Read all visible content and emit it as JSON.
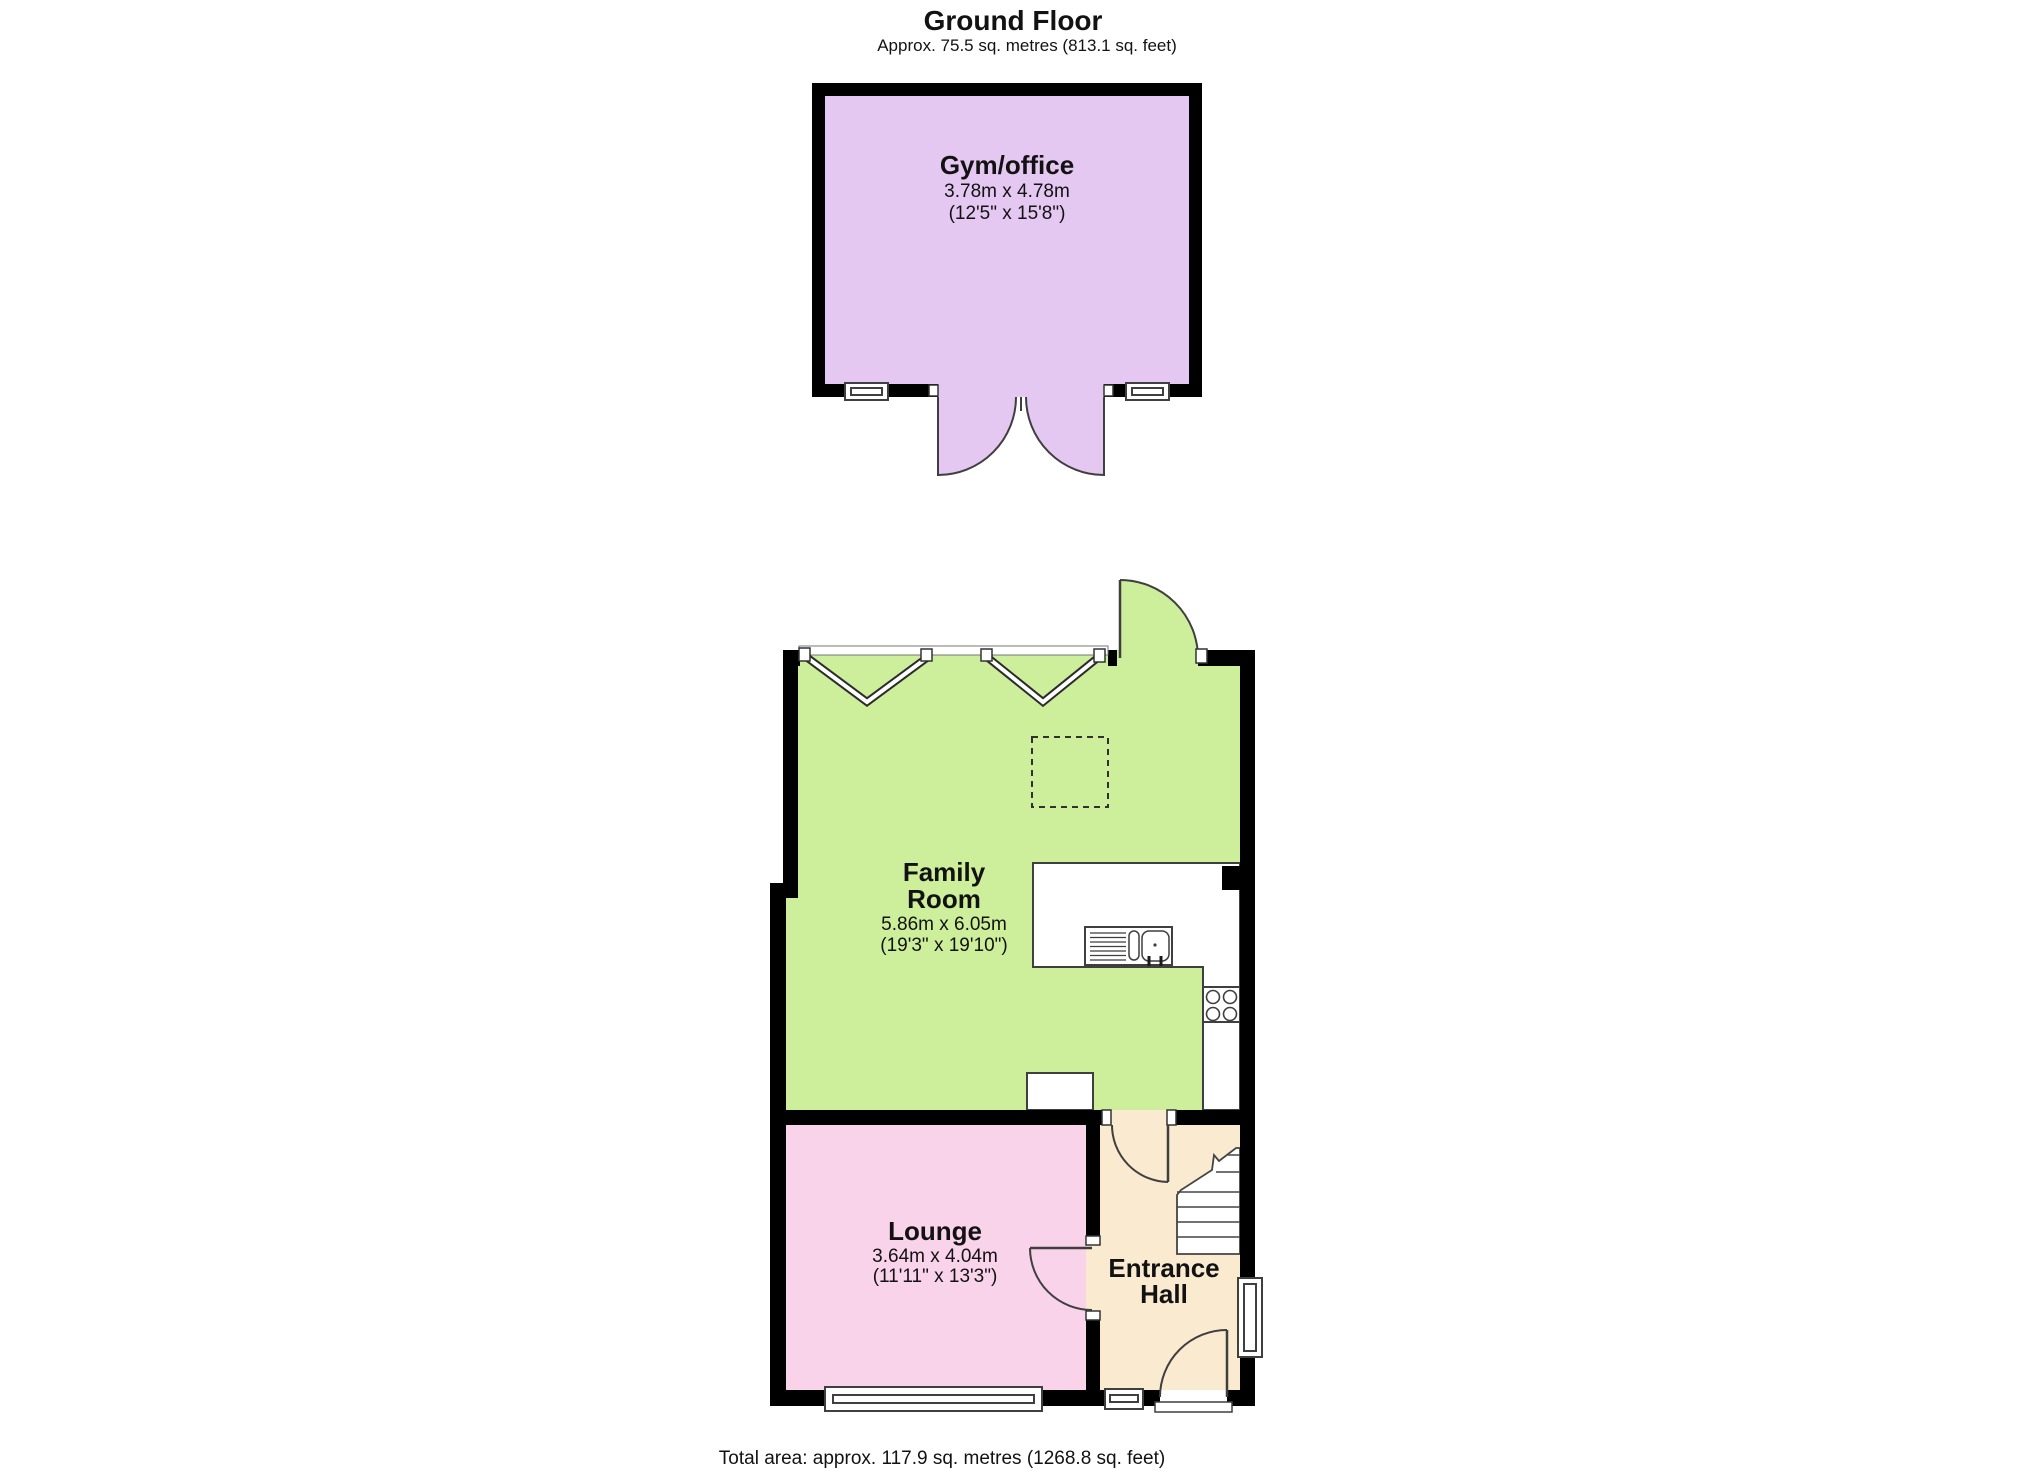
{
  "header": {
    "title": "Ground Floor",
    "subtitle": "Approx. 75.5 sq. metres (813.1 sq. feet)"
  },
  "footer": {
    "total_area": "Total area: approx. 117.9 sq. metres (1268.8 sq. feet)"
  },
  "rooms": [
    {
      "id": "gym-office",
      "name": "Gym/office",
      "dims_metric": "3.78m x 4.78m",
      "dims_imperial": "(12'5\" x 15'8\")",
      "fill": "#e5c8f2"
    },
    {
      "id": "family-room",
      "name_lines": [
        "Family",
        "Room"
      ],
      "dims_metric": "5.86m x 6.05m",
      "dims_imperial": "(19'3\" x 19'10\")",
      "fill": "#cdee9a"
    },
    {
      "id": "lounge",
      "name": "Lounge",
      "dims_metric": "3.64m x 4.04m",
      "dims_imperial": "(11'11\" x 13'3\")",
      "fill": "#f9d3e9"
    },
    {
      "id": "entrance-hall",
      "name_lines": [
        "Entrance",
        "Hall"
      ],
      "fill": "#faeacf"
    }
  ],
  "colors": {
    "wall": "#000000",
    "symbol_line": "#3f3f3f",
    "background": "#ffffff"
  }
}
